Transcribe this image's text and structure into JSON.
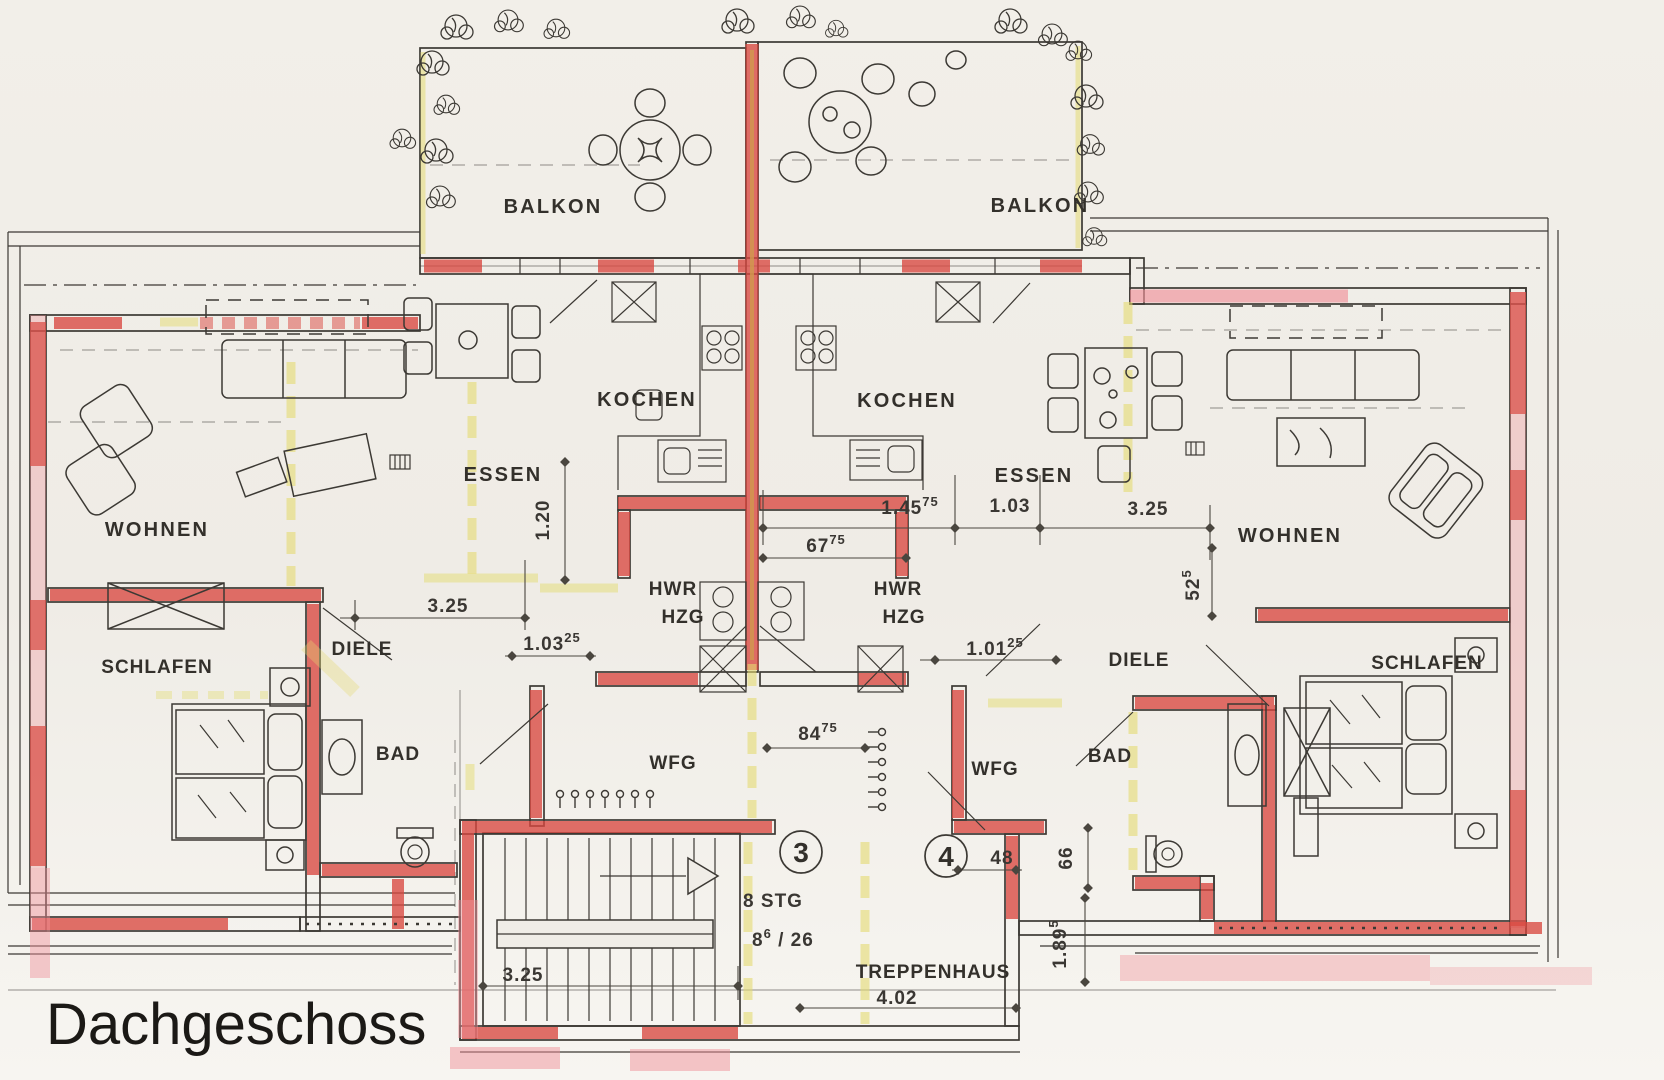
{
  "title": "Dachgeschoss",
  "colors": {
    "paper": "#f0ede7",
    "ink": "#3c3934",
    "wall_red": "#d94840",
    "wall_pink": "#ef9199",
    "wall_yellow": "#e4db72",
    "wall_orange": "#cf9a4e",
    "title_ink": "#1b1916"
  },
  "rooms": {
    "balkon_left": "BALKON",
    "balkon_right": "BALKON",
    "kochen_left": "KOCHEN",
    "kochen_right": "KOCHEN",
    "essen_left": "ESSEN",
    "essen_right": "ESSEN",
    "wohnen_left": "WOHNEN",
    "wohnen_right": "WOHNEN",
    "hwr_left": "HWR",
    "hzg_left": "HZG",
    "hwr_right": "HWR",
    "hzg_right": "HZG",
    "diele_left": "DIELE",
    "diele_right": "DIELE",
    "schlafen_left": "SCHLAFEN",
    "schlafen_right": "SCHLAFEN",
    "bad_left": "BAD",
    "bad_right": "BAD",
    "wfg_left": "WFG",
    "wfg_right": "WFG",
    "treppenhaus": "TREPPENHAUS"
  },
  "units": {
    "left": "3",
    "right": "4"
  },
  "stairs": {
    "count": "8 STG",
    "rise_base": "8",
    "rise_sup": "6",
    "rise_rest": " / 26"
  },
  "dims": {
    "d120": "1.20",
    "d325_left": "3.25",
    "d103_left": "1.03",
    "d103_left_sup": "25",
    "d67": "67",
    "d67_sup": "75",
    "d84": "84",
    "d84_sup": "75",
    "d145": "1.45",
    "d145_sup": "75",
    "d103_right": "1.03",
    "d325_right": "3.25",
    "d101": "1.01",
    "d101_sup": "25",
    "d52": "52",
    "d52_sup": "5",
    "d48": "48",
    "d66": "66",
    "d189": "1.89",
    "d189_sup": "5",
    "d325_bottom": "3.25",
    "d402": "4.02"
  }
}
